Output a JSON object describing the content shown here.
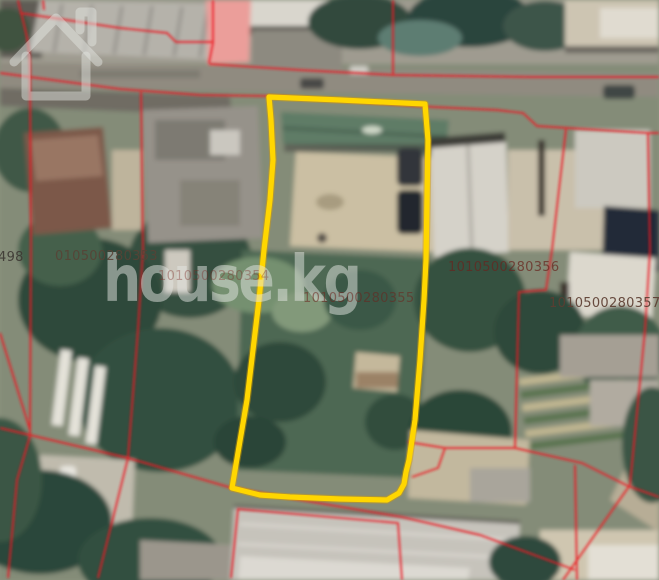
{
  "map": {
    "watermark": {
      "text": "house.kg",
      "icon": "house-icon"
    },
    "colors": {
      "selected_parcel": "#FFD600",
      "cadastral_line": "#EC1C24"
    },
    "labels": [
      {
        "id": "parcel-498",
        "text": "498"
      },
      {
        "id": "parcel-010500280353",
        "text": "010500280353"
      },
      {
        "id": "parcel-1010500280354",
        "text": "1010500280354"
      },
      {
        "id": "parcel-1010500280355",
        "text": "1010500280355"
      },
      {
        "id": "parcel-1010500280356",
        "text": "1010500280356"
      },
      {
        "id": "parcel-1010500280357",
        "text": "1010500280357"
      }
    ]
  }
}
